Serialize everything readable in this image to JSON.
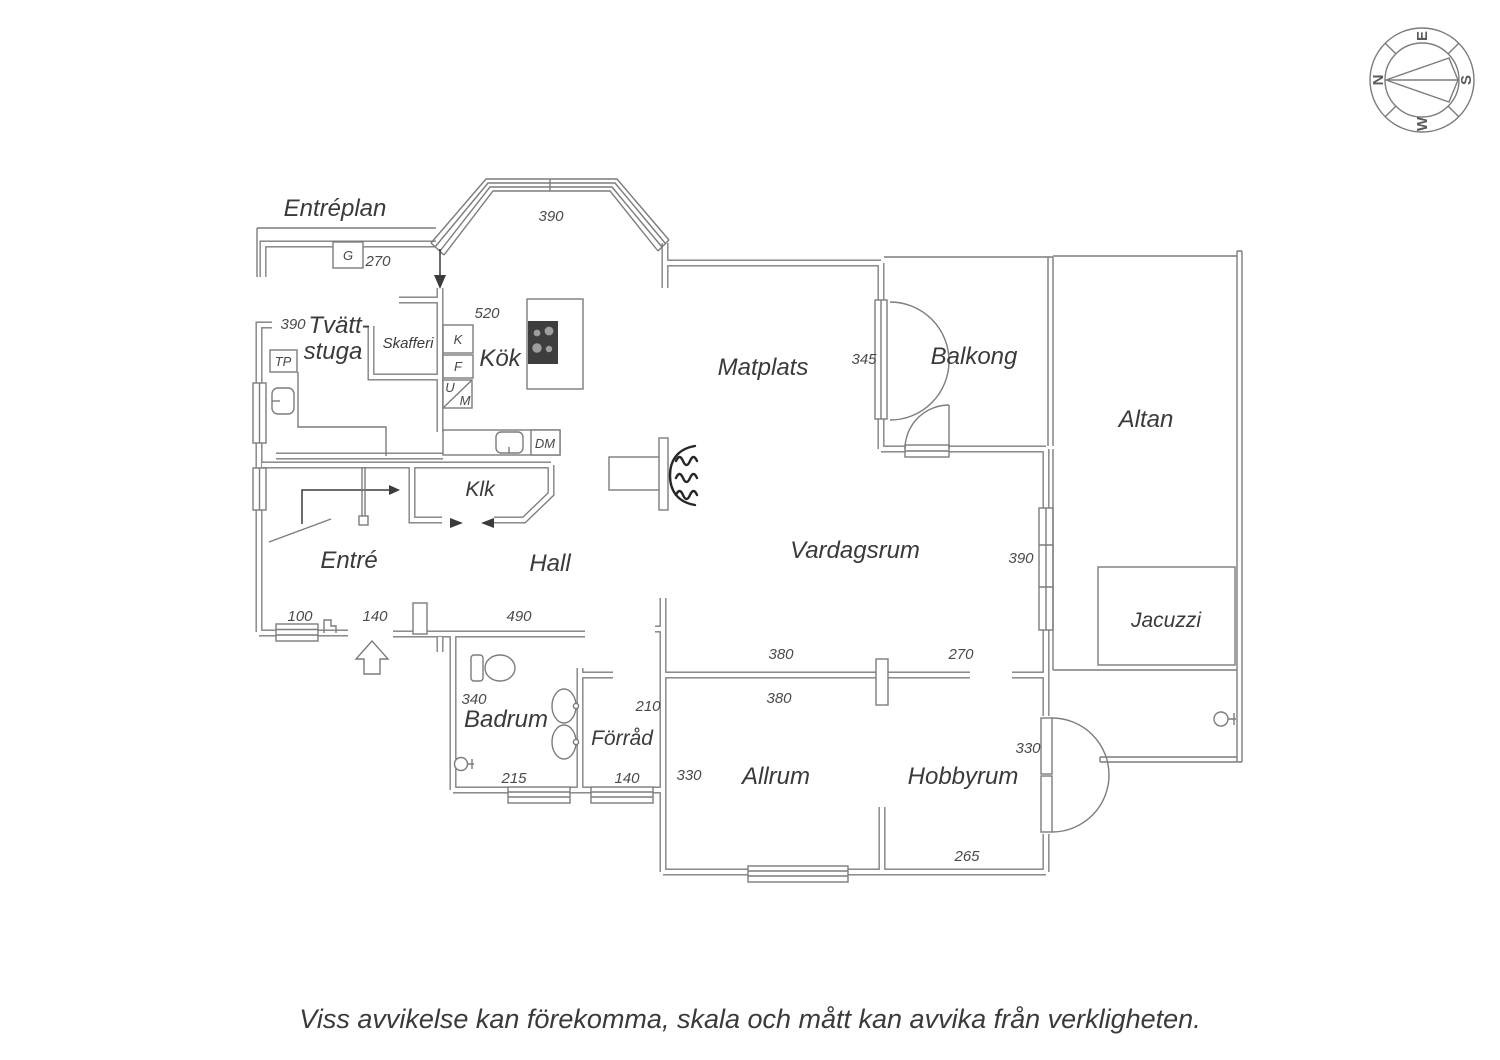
{
  "footer": {
    "disclaimer": "Viss avvikelse kan förekomma, skala och mått kan avvika från verkligheten."
  },
  "compass": {
    "n": "N",
    "e": "E",
    "s": "S",
    "w": "W"
  },
  "floorplan": {
    "title": "Entréplan",
    "rooms": {
      "tvattstuga_line1": "Tvätt-",
      "tvattstuga_line2": "stuga",
      "skafferi": "Skafferi",
      "kok": "Kök",
      "klk": "Klk",
      "entre": "Entré",
      "hall": "Hall",
      "matplats": "Matplats",
      "vardagsrum": "Vardagsrum",
      "balkong": "Balkong",
      "altan": "Altan",
      "jacuzzi": "Jacuzzi",
      "badrum": "Badrum",
      "forrad": "Förråd",
      "allrum": "Allrum",
      "hobbyrum": "Hobbyrum"
    },
    "fixtures": {
      "g": "G",
      "tp": "TP",
      "k": "K",
      "f": "F",
      "u": "U",
      "m": "M",
      "dm": "DM"
    },
    "dimensions": {
      "bay_window": "390",
      "porch": "270",
      "tvattstuga": "390",
      "kok": "520",
      "balkong": "345",
      "vardagsrum_window": "390",
      "vardagsrum_width": "380",
      "vardagsrum_right": "270",
      "entre_window": "100",
      "entre_door": "140",
      "hall": "490",
      "badrum_height": "340",
      "badrum_width": "215",
      "forrad_height": "210",
      "forrad_width": "140",
      "allrum_height": "330",
      "allrum_width": "380",
      "hobbyrum_door": "330",
      "hobbyrum_width": "265"
    }
  },
  "colors": {
    "line": "#7c7c7c",
    "room_text": "#3a3a3a",
    "dim_text": "#4a4a4a",
    "stove": "#3e3e3e",
    "flame_lines": "#262626"
  }
}
